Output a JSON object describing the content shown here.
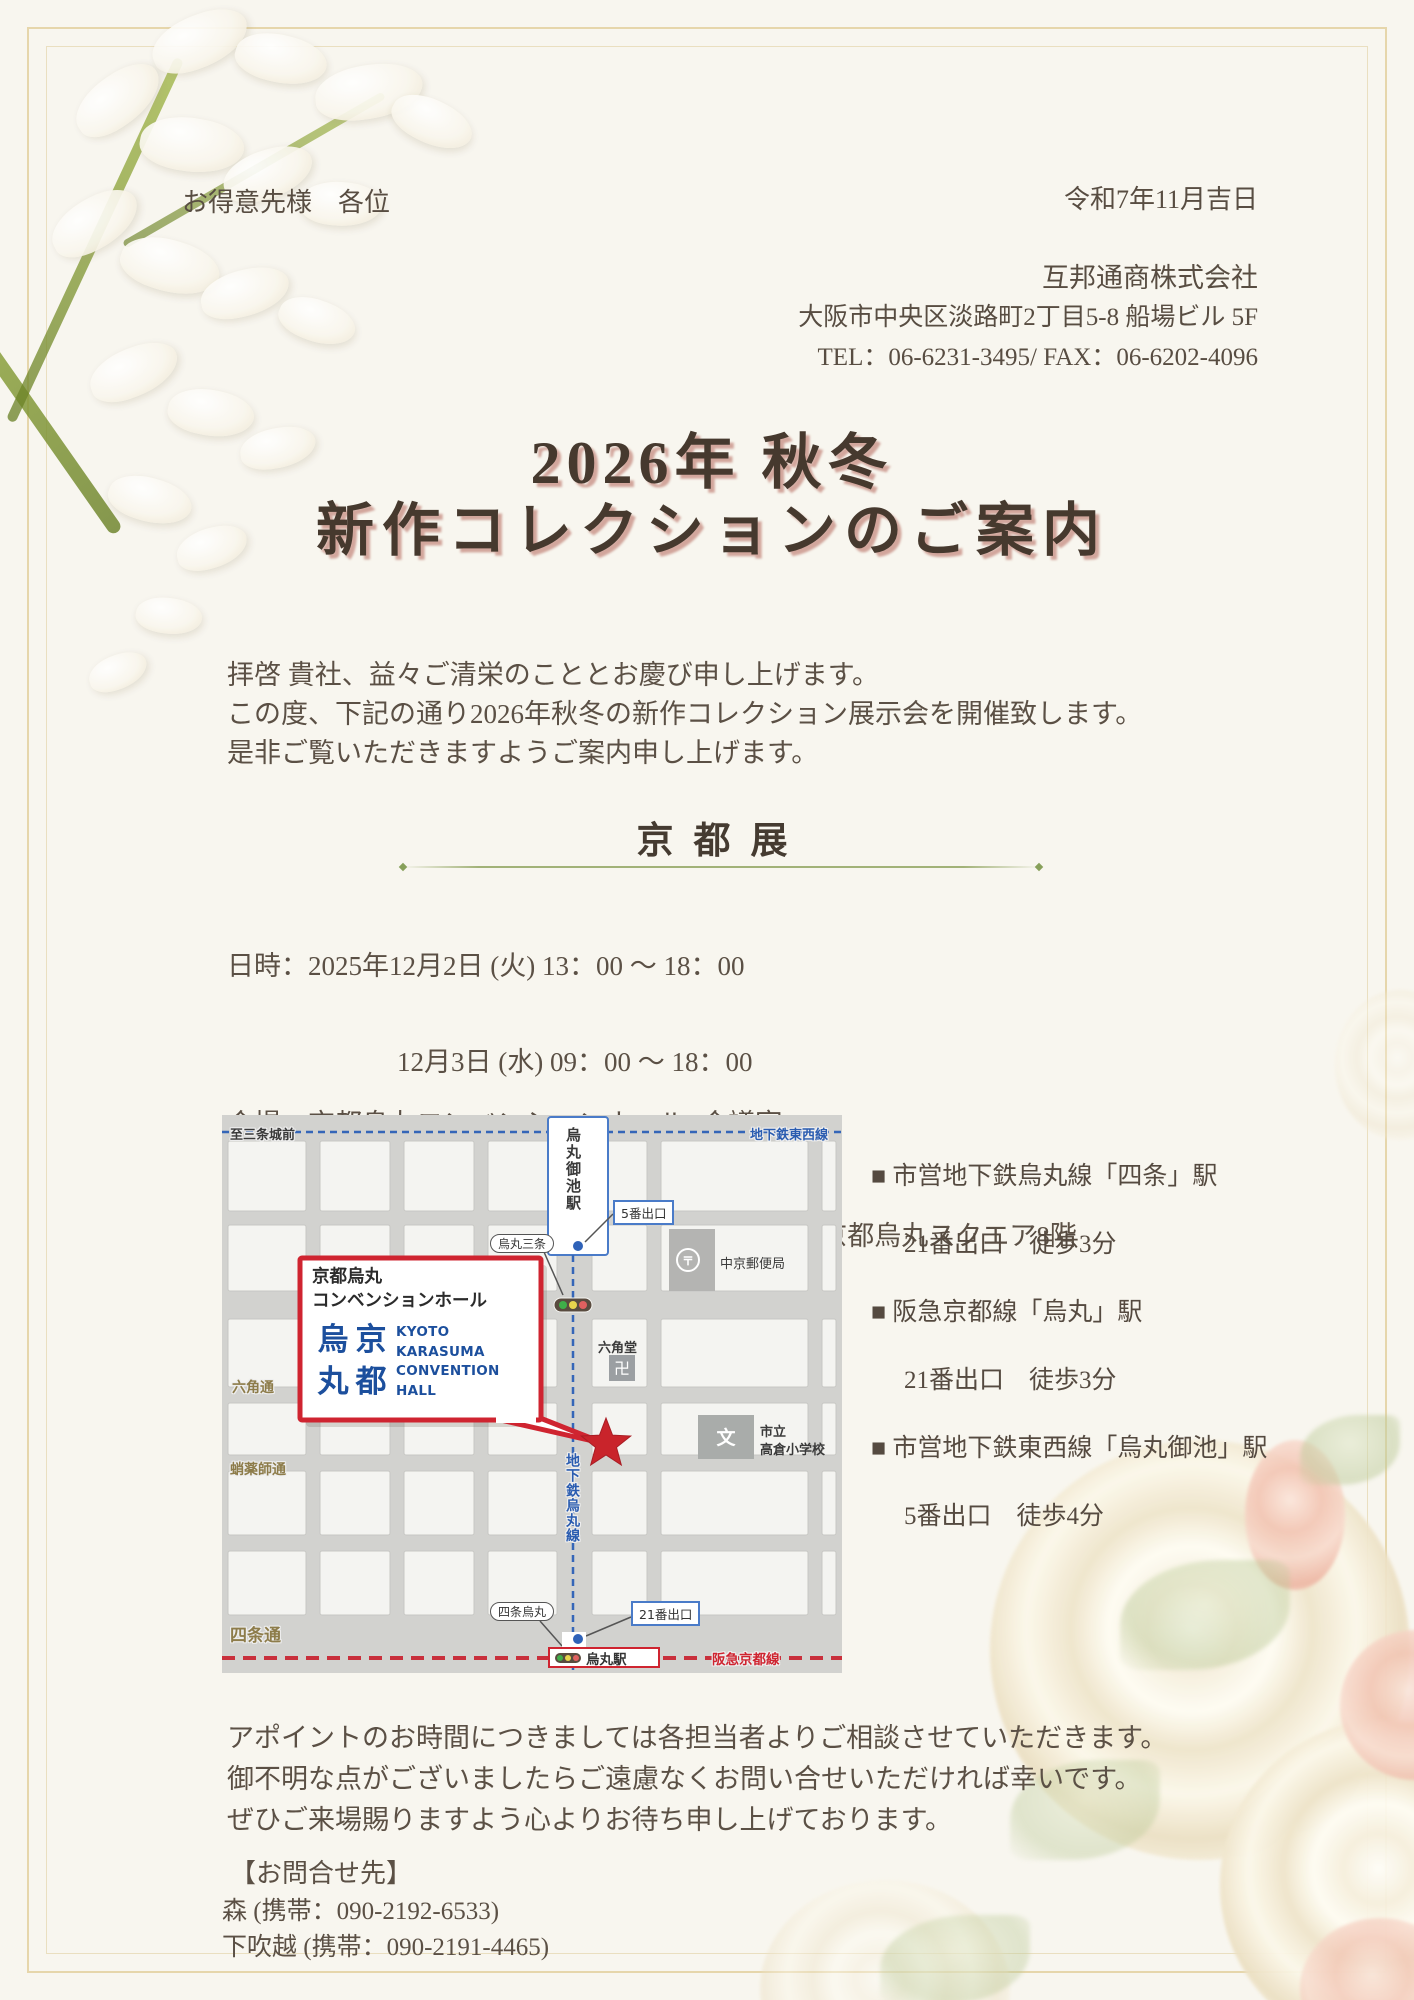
{
  "letter": {
    "recipient": "お得意先様　各位",
    "issue_date": "令和7年11月吉日",
    "company_name": "互邦通商株式会社",
    "company_address": "大阪市中央区淡路町2丁目5-8 船場ビル 5F",
    "company_tel_fax": "TEL：06-6231-3495/ FAX：06-6202-4096",
    "title_line1": "2026年 秋冬",
    "title_line2": "新作コレクションのご案内",
    "greeting_line1": "拝啓 貴社、益々ご清栄のこととお慶び申し上げます。",
    "greeting_line2": "この度、下記の通り2026年秋冬の新作コレクション展示会を開催致します。",
    "greeting_line3": "是非ご覧いただきますようご案内申し上げます。",
    "closing_line1": "アポイントのお時間につきましては各担当者よりご相談させていただきます。",
    "closing_line2": "御不明な点がございましたらご遠慮なくお問い合せいただければ幸いです。",
    "closing_line3": "ぜひご来場賜りますよう心よりお待ち申し上げております。",
    "contact_heading": "【お問合せ先】",
    "contact_line1": "森  (携帯：090-2192-6533)",
    "contact_line2": "下吹越  (携帯：090-2191-4465)"
  },
  "exhibition": {
    "heading": "京都展",
    "schedule_line1": "日時：2025年12月2日 (火)  13：00 ～ 18：00",
    "schedule_line2": "12月3日 (水)  09：00 ～ 18：00",
    "schedule_line3": "12月4日 (木)  09：00 ～ 15：00",
    "venue_line1": "会場：京都烏丸コンベンションホール<会議室1>",
    "venue_line2": "中京区烏丸通六角下る七観音町634 ONEST京都烏丸スクエア8階"
  },
  "access": {
    "item1_station": "■ 市営地下鉄烏丸線「四条」駅",
    "item1_exit": "21番出口　徒歩3分",
    "item2_station": "■ 阪急京都線「烏丸」駅",
    "item2_exit": "21番出口　徒歩3分",
    "item3_station": "■ 市営地下鉄東西線「烏丸御池」駅",
    "item3_exit": " 5番出口　徒歩4分"
  },
  "map": {
    "to_nijojo": "至三条城前",
    "tozai_line": "地下鉄東西線",
    "karasuma_oike_station": "烏丸御池駅",
    "exit5": "5番出口",
    "karasuma_sanjo": "烏丸三条",
    "post_office": "中京郵便局",
    "post_icon": "〒",
    "rokkaku_street": "六角通",
    "rokkakudo": "六角堂",
    "manji_icon": "卍",
    "hall_name_line1": "京都烏丸",
    "hall_name_line2": "コンベンションホール",
    "logo_k1": "烏",
    "logo_k2": "京",
    "logo_k3": "丸",
    "logo_k4": "都",
    "logo_en1": "KYOTO",
    "logo_en2": "KARASUMA",
    "logo_en3": "CONVENTION",
    "logo_en4": "HALL",
    "takoyakushi_street": "蛸薬師通",
    "karasuma_subway_line": "地下鉄烏丸線",
    "school_line1": "市立",
    "school_line2": "高倉小学校",
    "school_icon": "文",
    "shijo_street": "四条通",
    "shijo_karasuma": "四条烏丸",
    "exit21": "21番出口",
    "karasuma_station": "烏丸駅",
    "hankyu_line": "阪急京都線"
  },
  "colors": {
    "page_background": "#f8f6ef",
    "frame_gold": "#e6d6ab",
    "title_brown": "#46392e",
    "title_shadow_pink": "#cb988d",
    "body_text": "#5b5045",
    "divider_olive": "#a2b278",
    "map_red_accent": "#cf2430",
    "map_subway_blue": "#2a5cb0",
    "map_street_olive": "#8d7c4a",
    "hall_logo_blue": "#1c4f9d"
  }
}
